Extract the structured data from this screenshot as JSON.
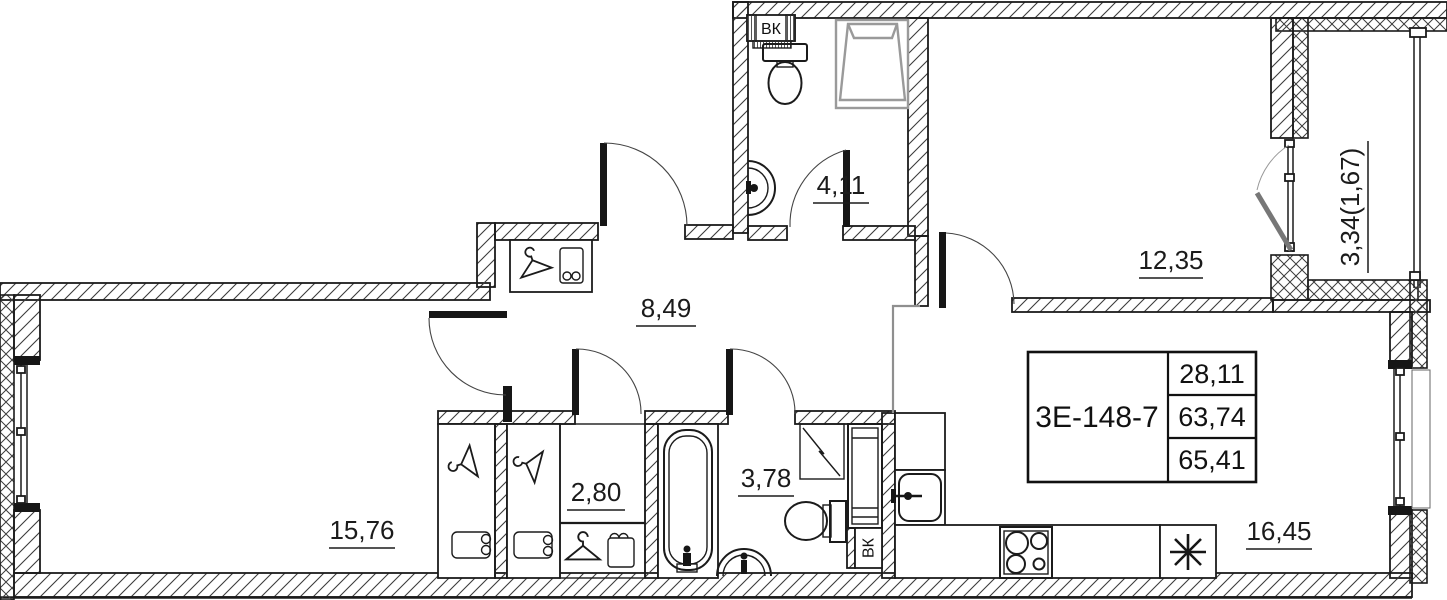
{
  "plan": {
    "unit": {
      "code": "3Е-148-7",
      "living_area": "28,11",
      "area_without_balcony": "63,74",
      "total_area": "65,41"
    },
    "rooms": [
      {
        "name": "bathroom-wc",
        "area": "4,11"
      },
      {
        "name": "bedroom",
        "area": "12,35"
      },
      {
        "name": "balcony",
        "area": "3,34(1,67)"
      },
      {
        "name": "hallway",
        "area": "8,49"
      },
      {
        "name": "wardrobe-room",
        "area": "2,80"
      },
      {
        "name": "bathroom",
        "area": "3,78"
      },
      {
        "name": "living-room",
        "area": "15,76"
      },
      {
        "name": "kitchen-living-room",
        "area": "16,45"
      }
    ],
    "ducts": {
      "wc_shaft_top": "ВК",
      "wc_shaft_bottom": "ВК"
    },
    "colors": {
      "line": "#1b1b1b",
      "shower_gray": "#9a9a9a",
      "zone_boundary_gray": "#8f8f8f"
    }
  }
}
